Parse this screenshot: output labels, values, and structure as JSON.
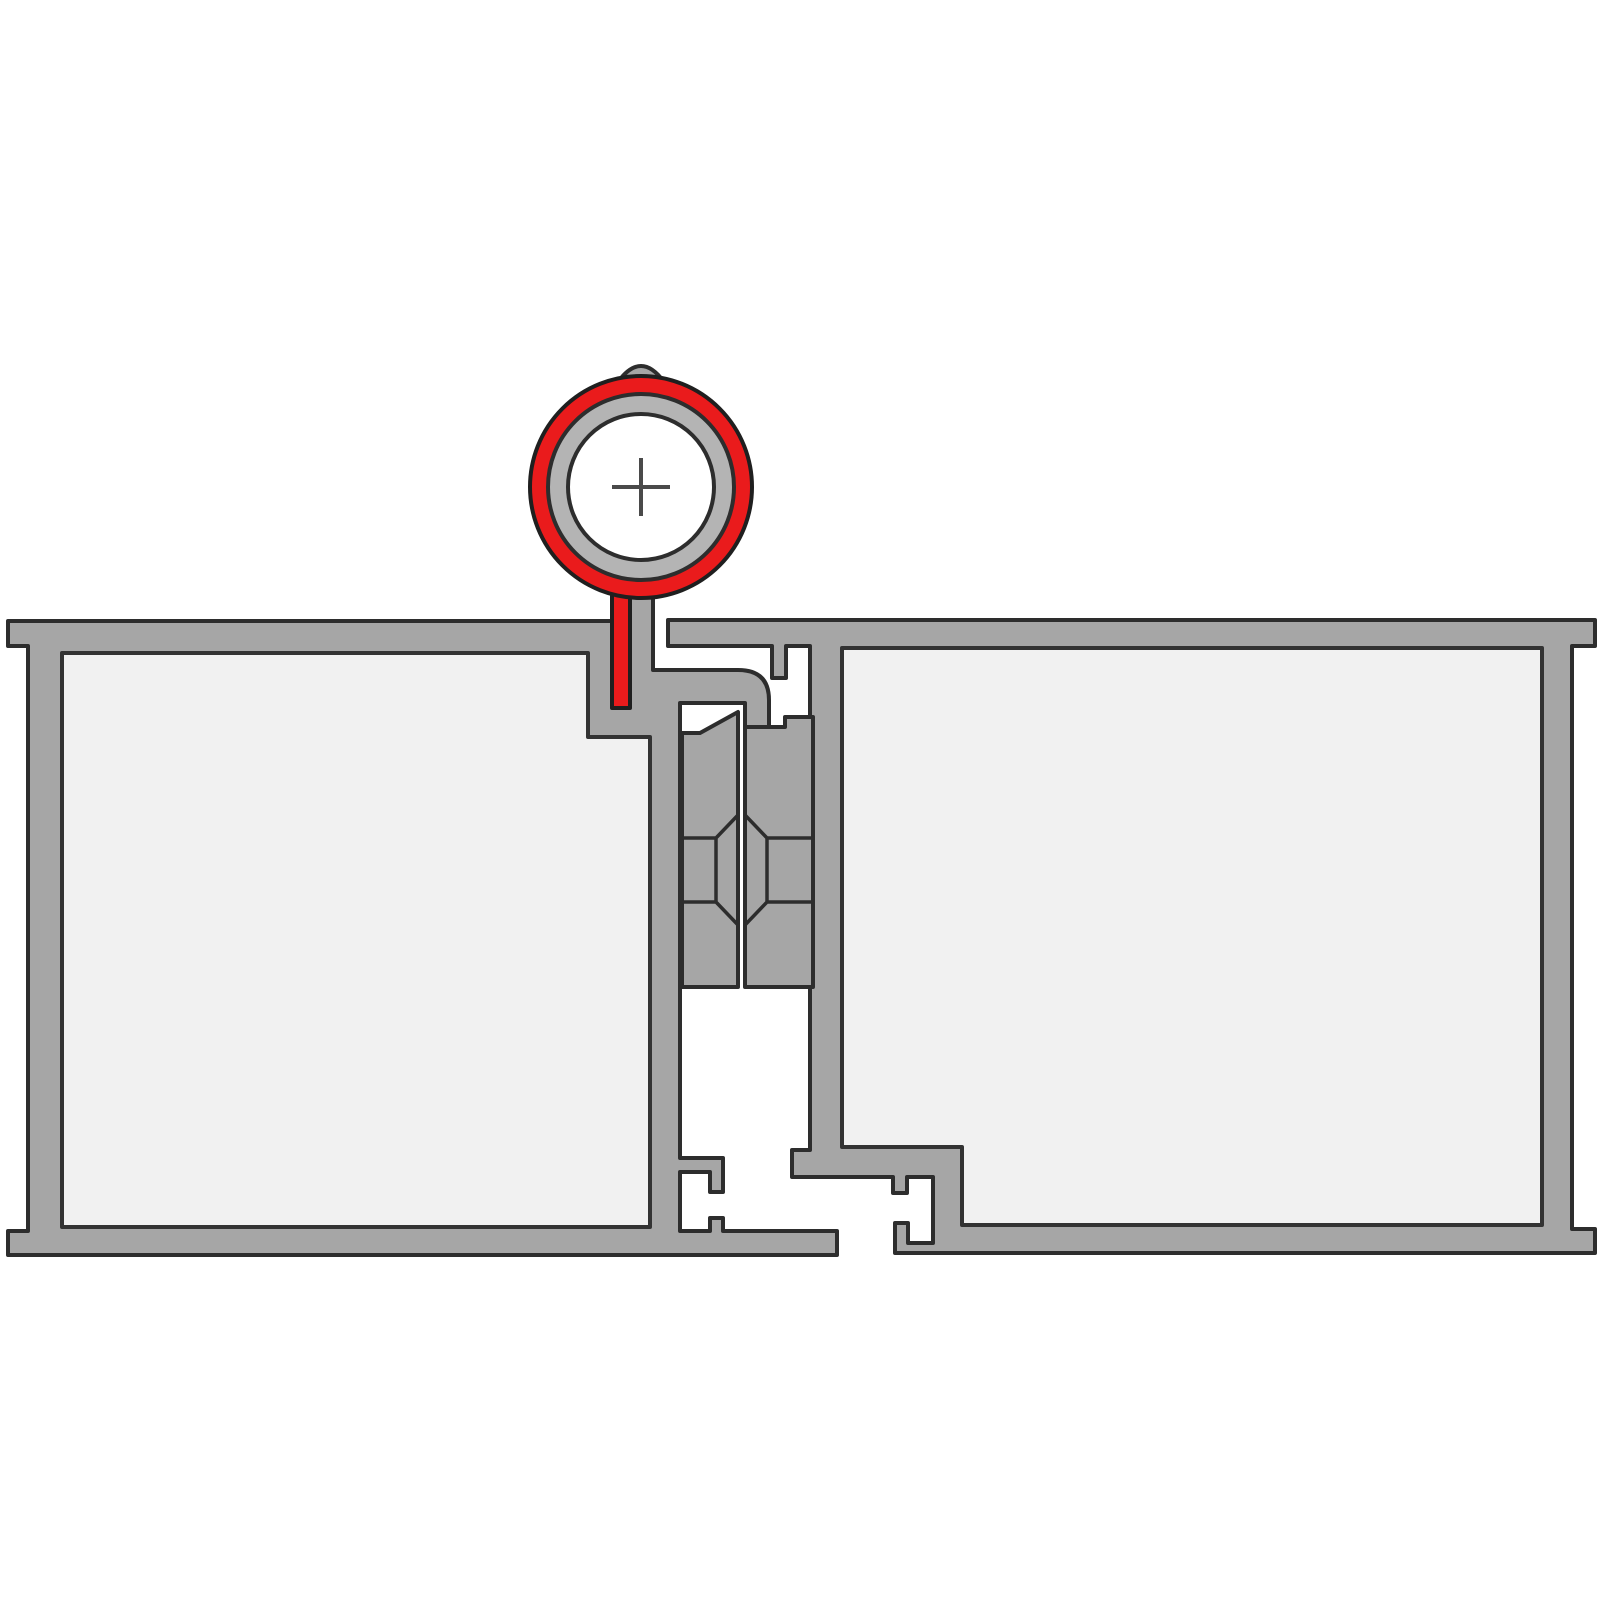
{
  "diagram": {
    "title": "Aluminium profile joint cross-section with pivot gasket",
    "type": "technical-cross-section",
    "parts": {
      "left_frame": "left aluminium frame profile",
      "right_frame": "right aluminium frame profile",
      "left_glazing": "left infill panel",
      "right_glazing": "right infill panel",
      "left_insert": "left coupling insert",
      "right_insert": "right coupling insert",
      "screw_boss": "octagonal screw boss",
      "gasket": "pivot gasket (highlighted red)",
      "pivot_pin": "pivot pin bore with center crosshair"
    }
  },
  "colors": {
    "background": "#ffffff",
    "profile": "#a6a6a6",
    "ring_gray": "#b4b4b4",
    "outline": "#2d2d2d",
    "glazing_fill": "#f1f1f1",
    "glazing_outline": "#333333",
    "gasket_red": "#ea1b1c",
    "gasket_outline": "#1f1f1f",
    "pin_core": "#ffffff",
    "crosshair": "#4a4a4a"
  }
}
